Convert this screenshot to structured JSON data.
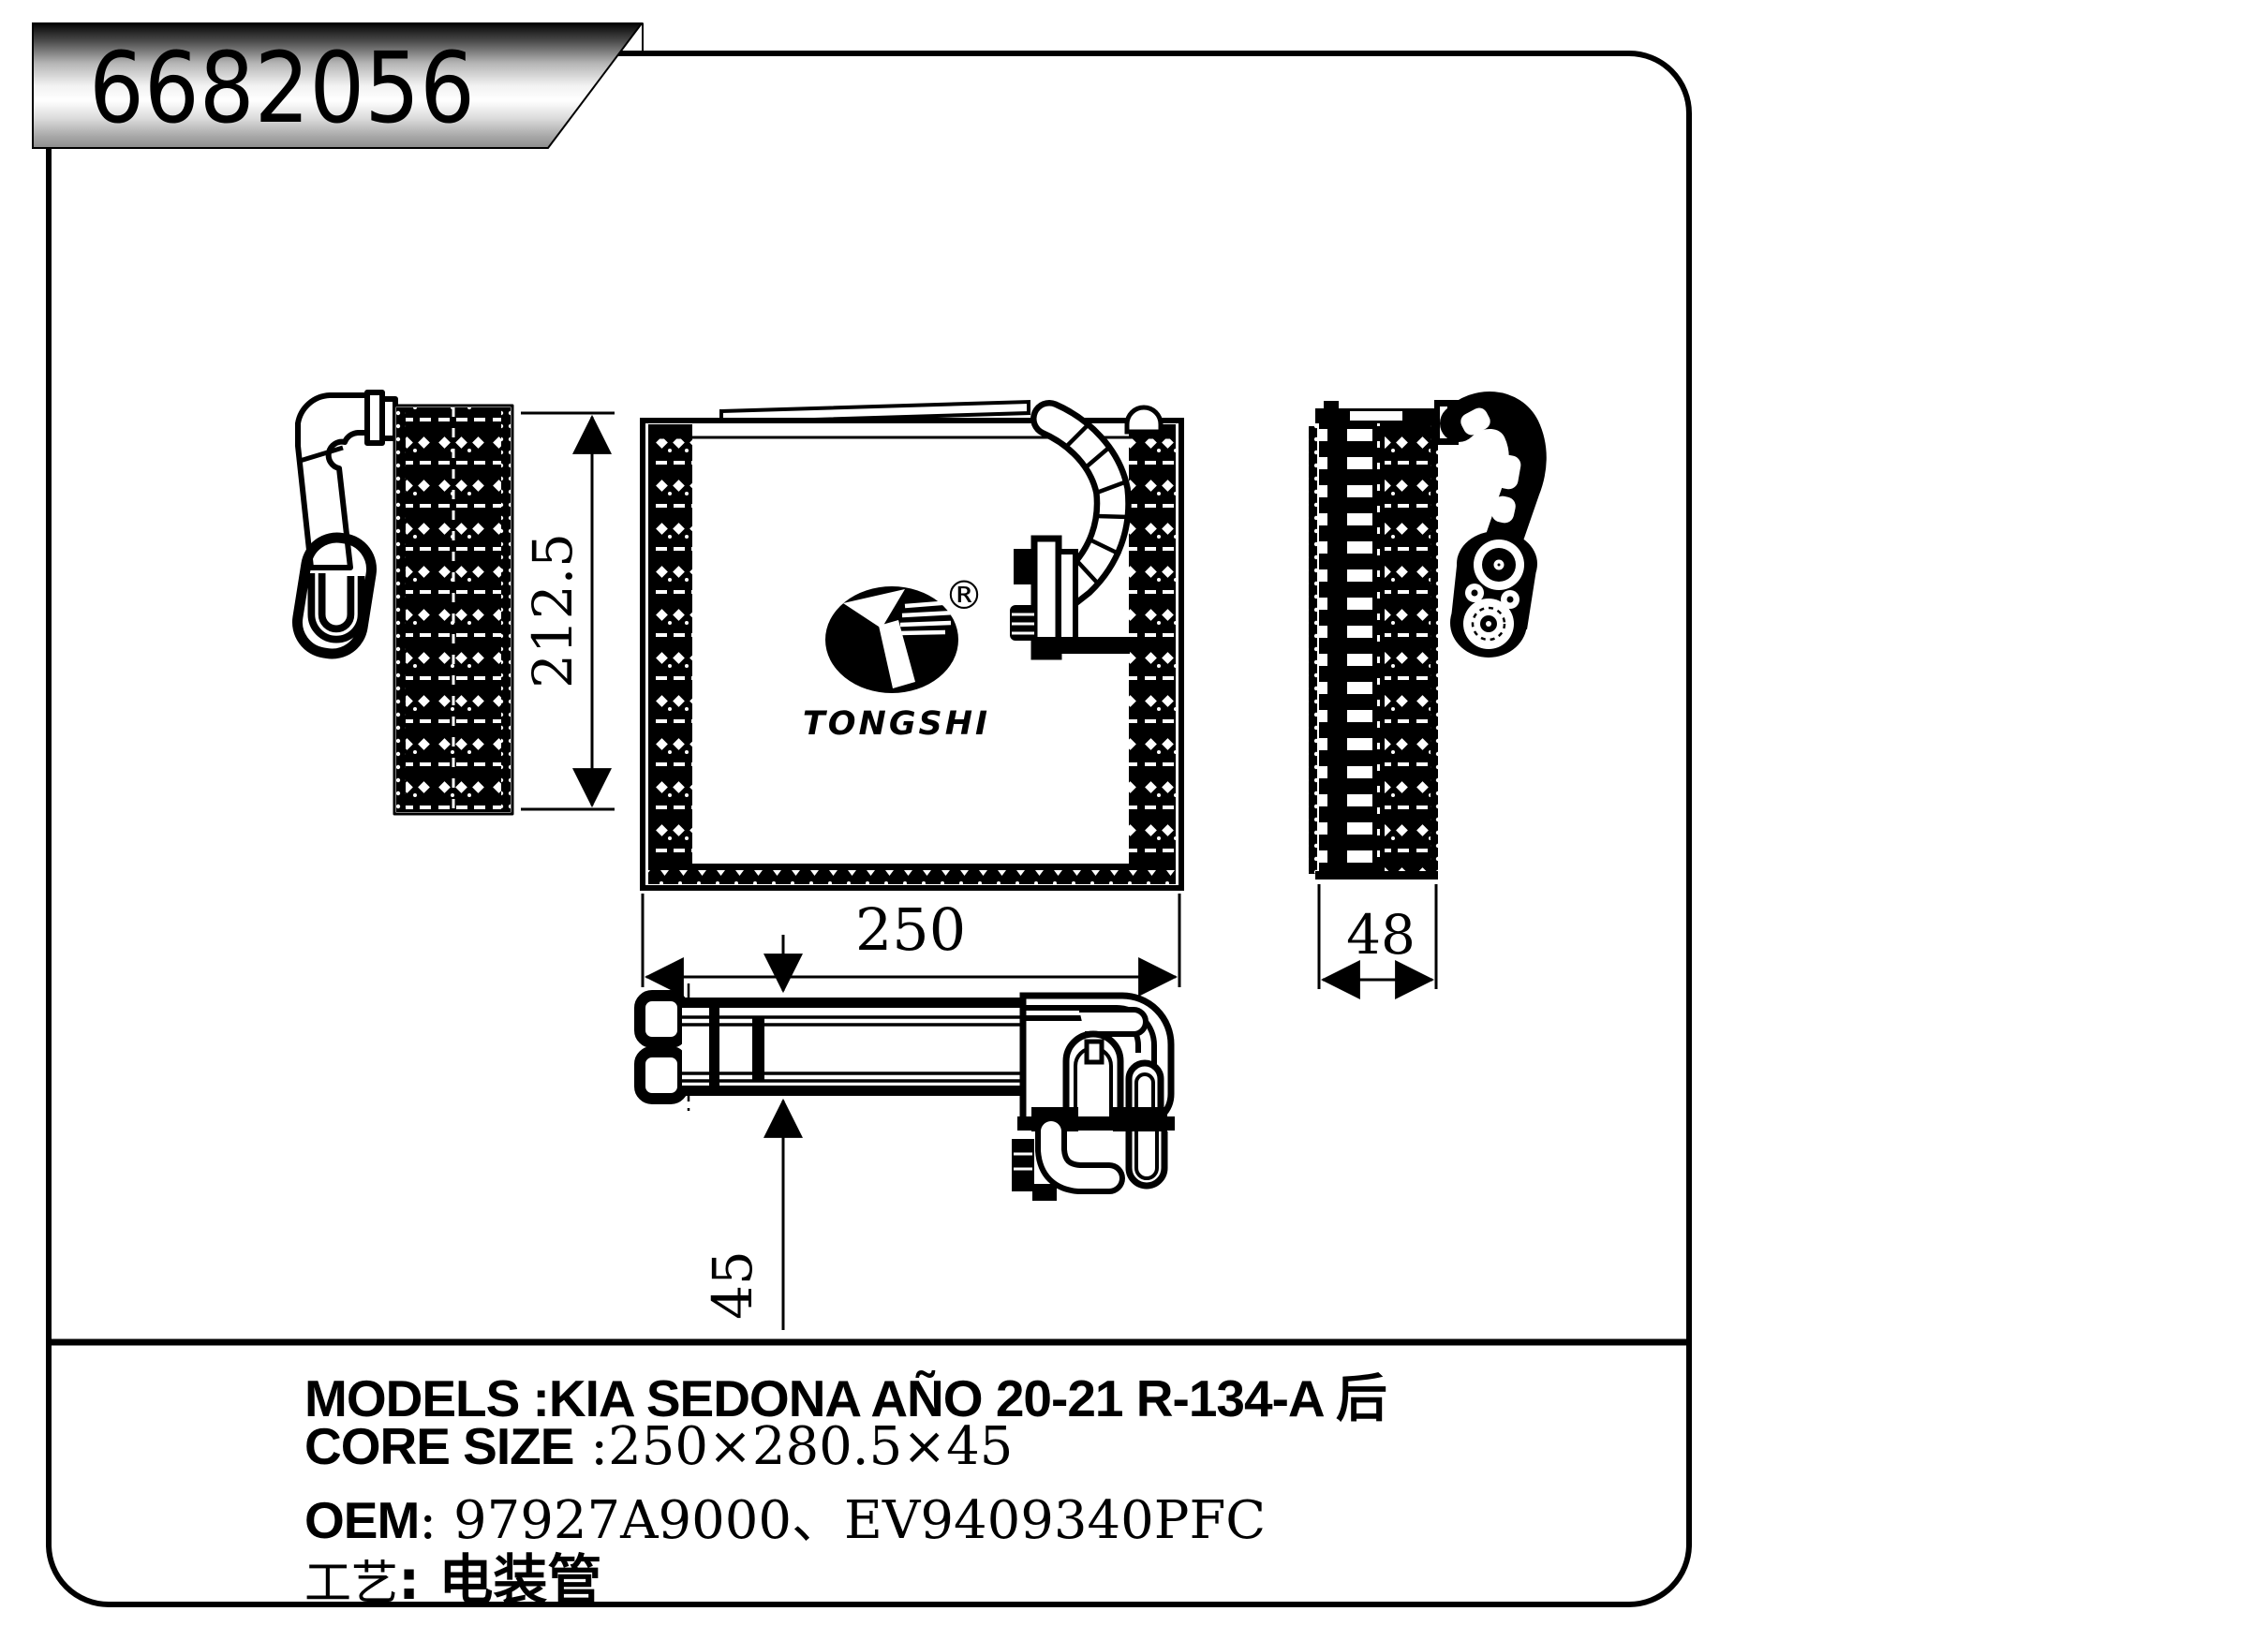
{
  "part_number": "6682056",
  "brand": {
    "name": "TONGSHI",
    "registered_mark": "®"
  },
  "dimensions": {
    "height": "212.5",
    "width": "250",
    "depth": "48",
    "thickness": "45"
  },
  "specs": {
    "models_label": "MODELS",
    "models_value": " :KIA SEDONA AÑO 20-21 R-134-A 后",
    "core_size_label": "CORE SIZE",
    "core_size_value": " :250×280.5×45",
    "oem_label": "OEM",
    "oem_value": ": 97927A9000、EV9409340PFC",
    "process_label": "工艺",
    "process_value": ": 电装管"
  }
}
